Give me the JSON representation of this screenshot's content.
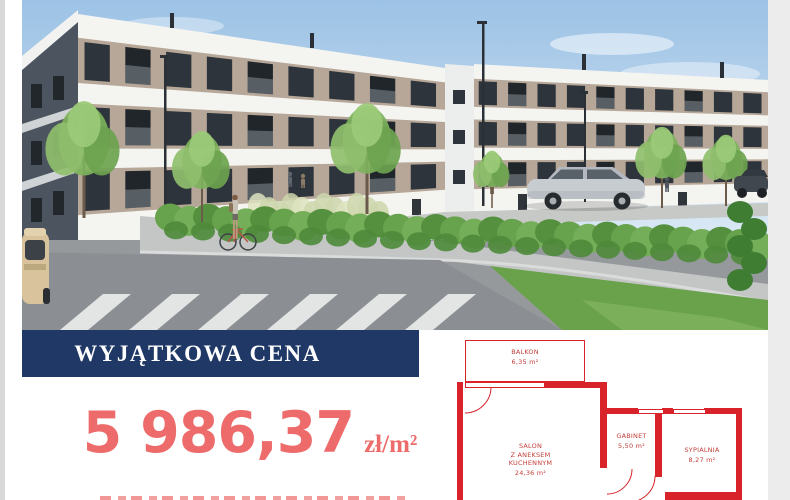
{
  "banner": {
    "label": "WYJĄTKOWA CENA",
    "bg_color": "#1f3866",
    "text_color": "#ffffff"
  },
  "price": {
    "amount": "5 986,37",
    "unit": "zł/m²",
    "color": "#ee6b6b"
  },
  "floorplan": {
    "wall_color": "#d8232a",
    "label_color": "#c2403a",
    "rooms": {
      "balkon": {
        "name": "BALKON",
        "area": "6,35 m²"
      },
      "salon": {
        "name_lines": [
          "SALON",
          "Z ANEKSEM",
          "KUCHENNYM"
        ],
        "area": "24,36 m²"
      },
      "gabinet": {
        "name": "GABINET",
        "area": "5,50 m²"
      },
      "sypialnia": {
        "name": "SYPIALNIA",
        "area": "8,27 m²"
      }
    }
  }
}
